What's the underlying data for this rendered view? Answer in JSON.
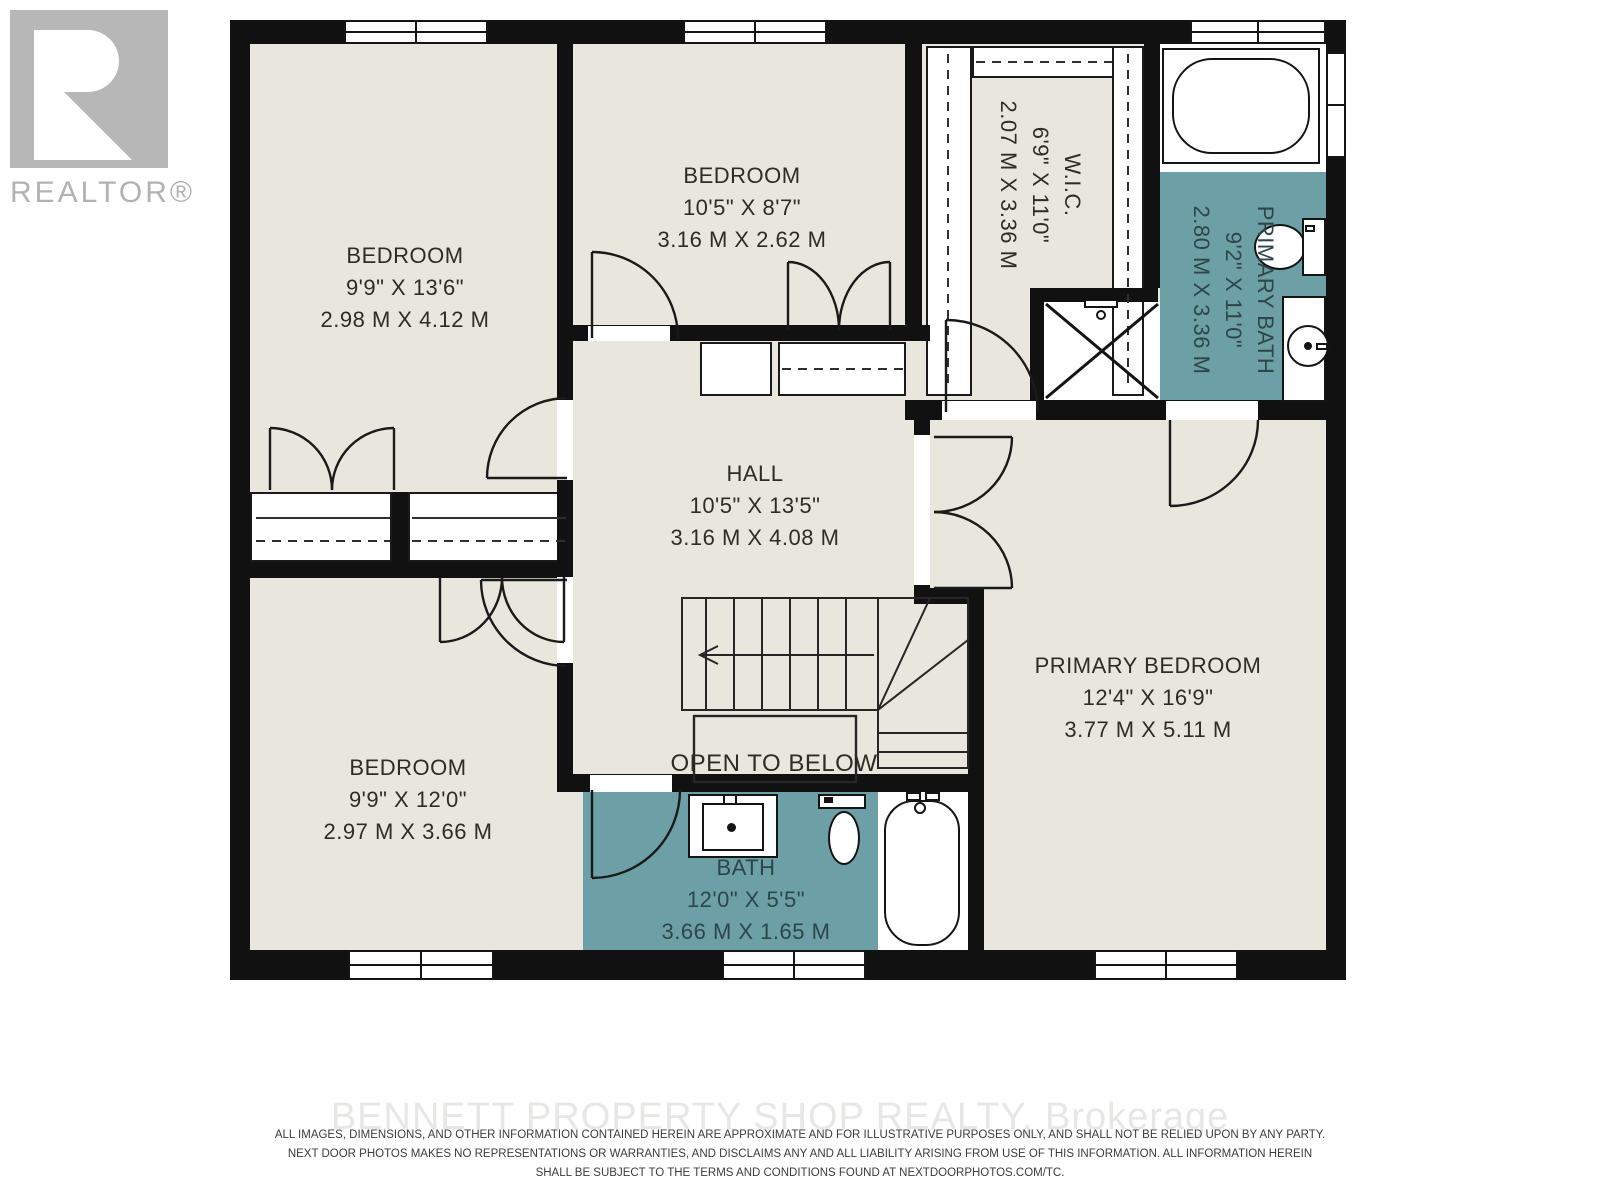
{
  "branding": {
    "realtor_label": "REALTOR®",
    "watermark": "BENNETT PROPERTY SHOP REALTY, Brokerage"
  },
  "rooms": {
    "bedroom_top_left": {
      "name": "BEDROOM",
      "imperial": "9'9\" X 13'6\"",
      "metric": "2.98 M X 4.12 M"
    },
    "bedroom_top_middle": {
      "name": "BEDROOM",
      "imperial": "10'5\" X 8'7\"",
      "metric": "3.16 M X 2.62 M"
    },
    "walk_in_closet": {
      "name": "W.I.C.",
      "imperial": "6'9\" X 11'0\"",
      "metric": "2.07 M X 3.36 M"
    },
    "primary_bath": {
      "name": "PRIMARY BATH",
      "imperial": "9'2\" X 11'0\"",
      "metric": "2.80 M X 3.36 M"
    },
    "hall": {
      "name": "HALL",
      "imperial": "10'5\" X 13'5\"",
      "metric": "3.16 M X 4.08 M"
    },
    "bedroom_bottom_left": {
      "name": "BEDROOM",
      "imperial": "9'9\" X 12'0\"",
      "metric": "2.97 M X 3.66 M"
    },
    "primary_bedroom": {
      "name": "PRIMARY BEDROOM",
      "imperial": "12'4\" X 16'9\"",
      "metric": "3.77 M X 5.11 M"
    },
    "bath": {
      "name": "BATH",
      "imperial": "12'0\" X 5'5\"",
      "metric": "3.66 M X 1.65 M"
    }
  },
  "annotations": {
    "open_to_below": "OPEN TO BELOW"
  },
  "disclaimer": {
    "line1": "ALL IMAGES, DIMENSIONS, AND OTHER INFORMATION CONTAINED HEREIN ARE APPROXIMATE AND FOR ILLUSTRATIVE PURPOSES ONLY, AND SHALL NOT BE RELIED UPON BY ANY PARTY.",
    "line2": "NEXT DOOR PHOTOS MAKES NO REPRESENTATIONS OR WARRANTIES, AND DISCLAIMS ANY AND ALL LIABILITY ARISING FROM USE OF THIS INFORMATION. ALL INFORMATION HEREIN",
    "line3": "SHALL BE SUBJECT TO THE TERMS AND CONDITIONS FOUND AT NEXTDOORPHOTOS.COM/TC."
  },
  "colors": {
    "floor": "#e9e7dd",
    "bath_floor": "#6d9fa6",
    "wall": "#111111",
    "label_text": "#2e2c28",
    "bath_label_text": "#2d464b",
    "logo_gray": "#b7b7b7",
    "watermark": "#e7e7e5"
  }
}
